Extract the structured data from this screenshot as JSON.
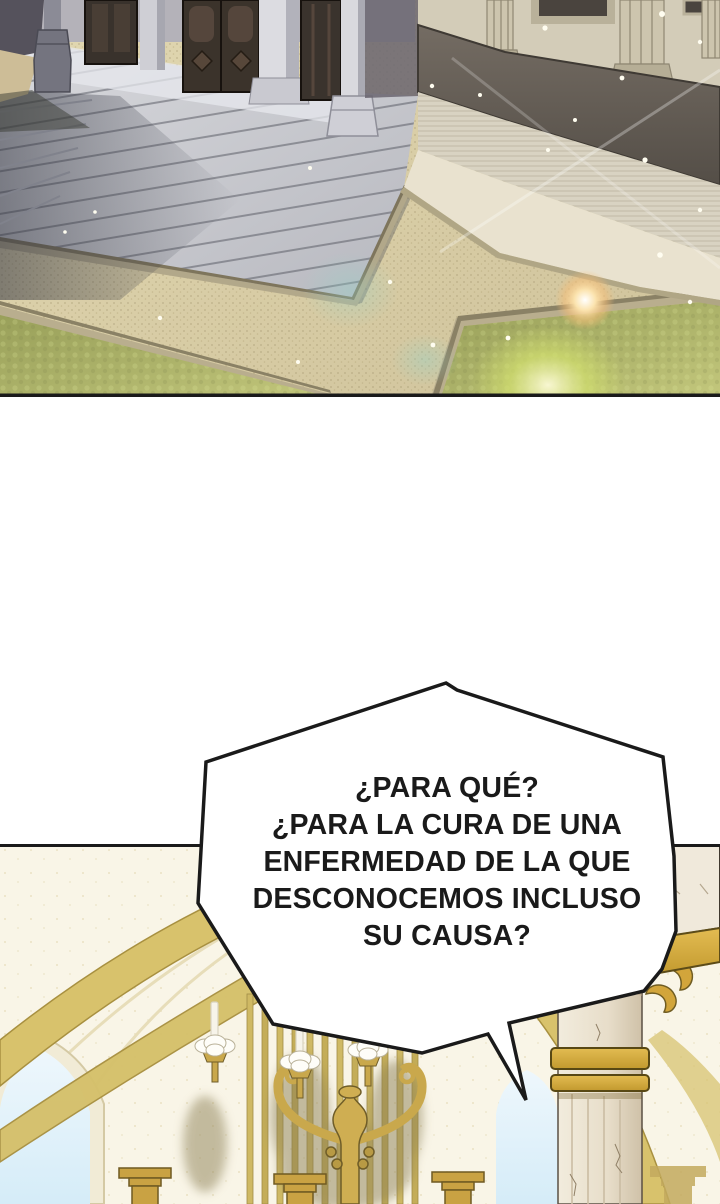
{
  "page": {
    "width": 720,
    "height": 1204
  },
  "palette": {
    "paper": "#ffffff",
    "ink": "#1a1a1a",
    "bubble_fill": "#ffffff",
    "gold": "#d2a53b",
    "arch_gold": "#d8c26c",
    "cream": "#f9f5e7",
    "sky_blue": "#d9edf8",
    "grass": "#a9b068",
    "gravel": "#d8cda6",
    "stone": "#c9cacf",
    "marble": "#ece3d2",
    "wood": "#3a322b"
  },
  "speech_bubble": {
    "fill": "#ffffff",
    "border": "#1a1a1a",
    "lines": [
      "¿PARA QUÉ?",
      "¿PARA LA CURA DE UNA",
      "ENFERMEDAD DE LA QUE",
      "DESCONOCEMOS INCLUSO",
      "SU CAUSA?"
    ]
  }
}
